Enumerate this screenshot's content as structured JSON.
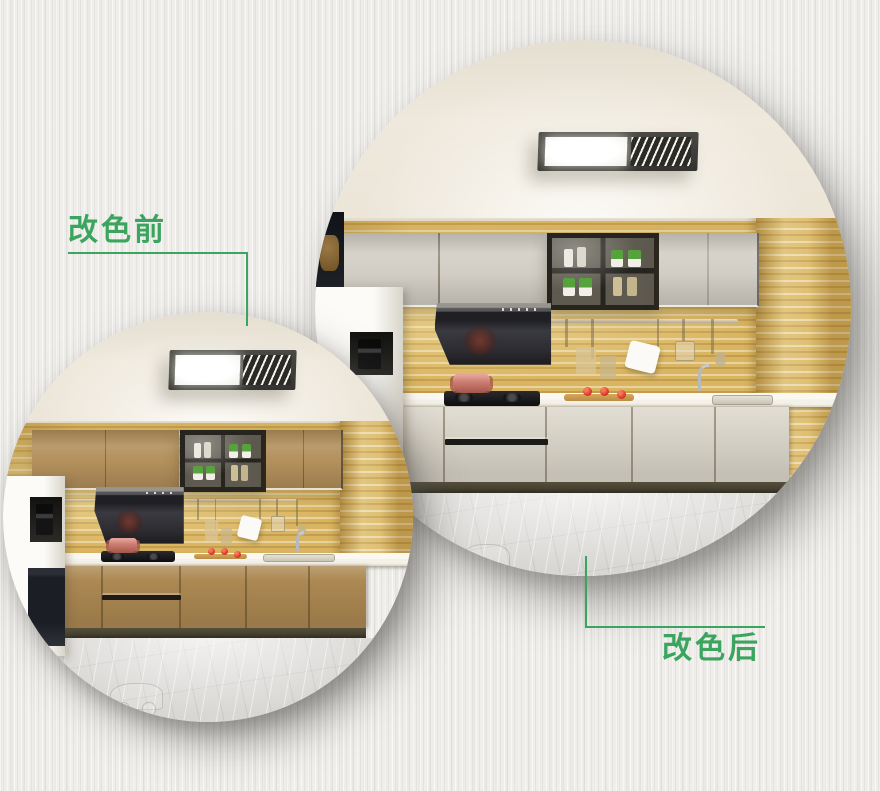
{
  "annotations": {
    "before": {
      "label": "改色前"
    },
    "after": {
      "label": "改色后"
    }
  },
  "colors": {
    "accent_green": "#3ba55f",
    "background": "#efeeeb",
    "cabinet_before_upper": "#b3905c",
    "cabinet_before_lower": "#ac8852",
    "cabinet_after_upper": "#d2cec5",
    "cabinet_after_lower": "#dbd6ca",
    "tile_backsplash": "#d9b561",
    "ceiling": "#efe9dd",
    "floor_marble": "#d9d7d4",
    "range_hood_dark": "#313136",
    "countertop": "#f4f1e9",
    "toe_kick": "#45402f",
    "glass_cabinet_frame": "#25241f",
    "tomato_red": "#e2402b",
    "copper_pot": "#cc7f72",
    "plant_green": "#56a23c"
  }
}
